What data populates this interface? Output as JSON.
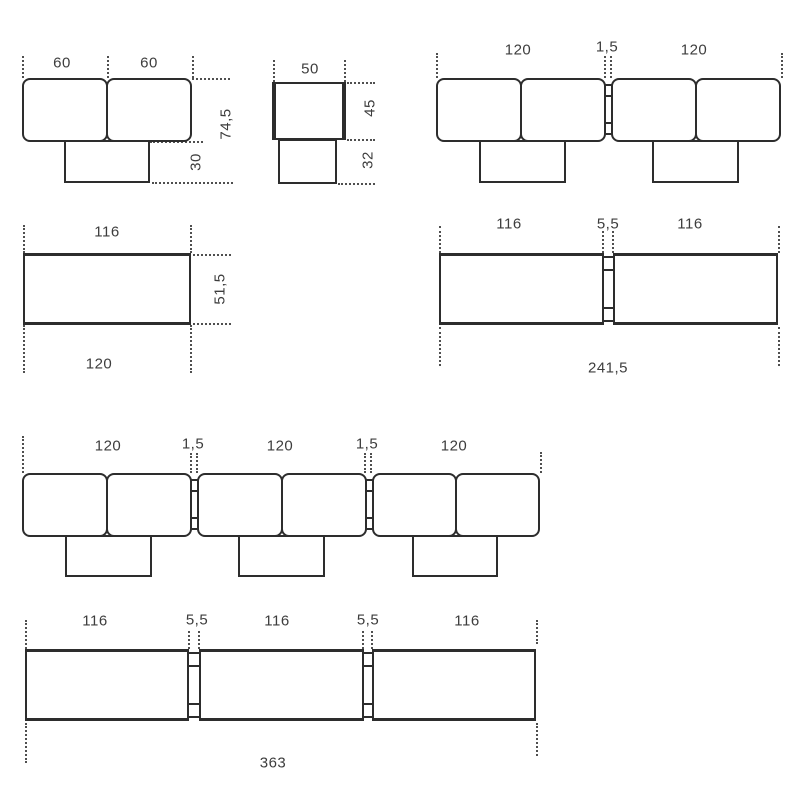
{
  "colors": {
    "line": "#2d2d2d",
    "text": "#3d3d3d",
    "dash": "#4f4f4f",
    "background": "#ffffff"
  },
  "figures": {
    "single_module_top": {
      "width_left": "60",
      "width_right": "60",
      "depth_total": "74,5",
      "base_depth": "30"
    },
    "pouf_top": {
      "width": "50",
      "depth": "45",
      "base_depth": "32"
    },
    "two_module_top": {
      "width_left": "120",
      "gap": "1,5",
      "width_right": "120"
    },
    "single_module_front": {
      "top_width": "116",
      "height": "51,5",
      "bottom_width": "120"
    },
    "two_module_front": {
      "width_left": "116",
      "gap": "5,5",
      "width_right": "116",
      "total_width": "241,5"
    },
    "three_module_top": {
      "width_1": "120",
      "gap_1": "1,5",
      "width_2": "120",
      "gap_2": "1,5",
      "width_3": "120"
    },
    "three_module_front": {
      "width_1": "116",
      "gap_1": "5,5",
      "width_2": "116",
      "gap_2": "5,5",
      "width_3": "116",
      "total_width": "363"
    }
  }
}
